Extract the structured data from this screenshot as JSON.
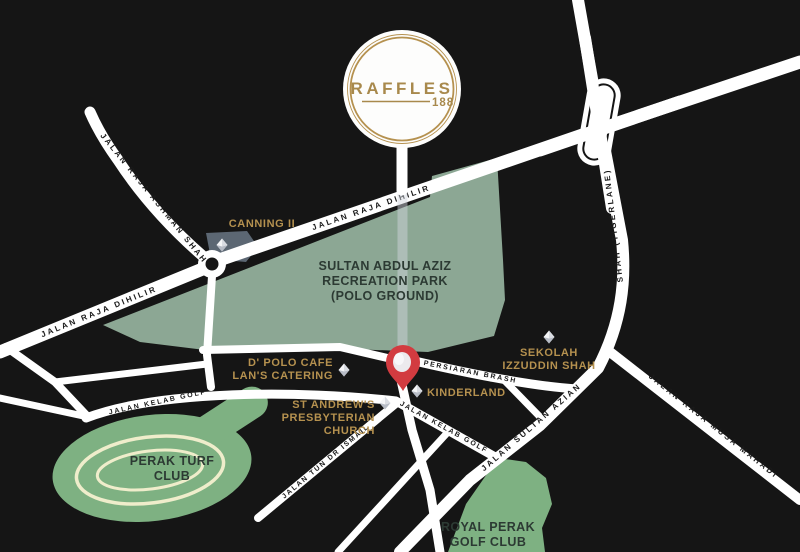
{
  "map": {
    "brand": {
      "name": "RAFFLES",
      "number": "188"
    },
    "road_labels": {
      "raja_ashman_shah": "JALAN RAJA ASHMAN SHAH",
      "raja_dihilir_west": "JALAN RAJA DIHILIR",
      "raja_dihilir_main": "JALAN RAJA DIHILIR",
      "tigerlane_vertical": "SHAH (TIGERLANE)",
      "sultan_azian_shah": "JALAN SULTAN AZIAN",
      "raja_musa_mahadi": "JALAN RAJA MUSA MAHADI",
      "kelab_golf_west": "JALAN KELAB GOLF",
      "kelab_golf_east": "JALAN KELAB GOLF",
      "tun_dr_ismail": "JALAN TUN DR ISMAIL",
      "persiaran_brash": "PERSIARAN BRASH"
    },
    "places": {
      "canning": "CANNING II",
      "park_line1": "SULTAN ABDUL AZIZ",
      "park_line2": "RECREATION PARK",
      "park_line3": "(POLO GROUND)",
      "dpolo_line1": "D' POLO CAFE",
      "dpolo_line2": "LAN'S CATERING",
      "church_line1": "ST ANDREW'S",
      "church_line2": "PRESBYTERIAN",
      "church_line3": "CHURCH",
      "kinderland": "KINDERLAND",
      "sekolah_line1": "SEKOLAH",
      "sekolah_line2": "IZZUDDIN SHAH",
      "turf_line1": "PERAK TURF",
      "turf_line2": "CLUB",
      "golf_line1": "ROYAL PERAK",
      "golf_line2": "GOLF CLUB"
    },
    "colors": {
      "background": "#151515",
      "road": "#FFFFFF",
      "road_text": "#1A1A1A",
      "park_green": "#8CA794",
      "club_green": "#7EB182",
      "track_cream": "#EFEDCB",
      "gold": "#B5914F",
      "area_text": "#2C3A33",
      "pin_red": "#D23B40",
      "canning_gray": "#5C6773"
    }
  }
}
